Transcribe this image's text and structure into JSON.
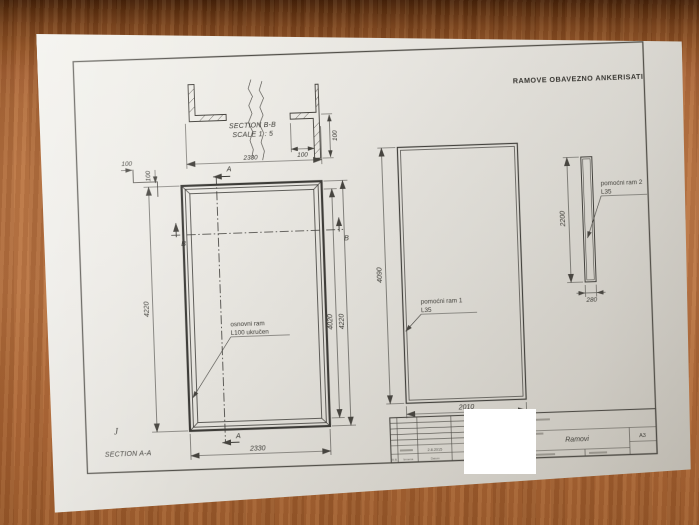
{
  "note": "RAMOVE OBAVEZNO ANKERISATI",
  "sectionBB": {
    "title": "SECTION B-B",
    "scale": "SCALE 1 : 5",
    "dimWidth": "2330",
    "dimLeg": "100",
    "dimFlange": "100"
  },
  "cornerDetail": {
    "dimH": "100",
    "dimV": "100"
  },
  "mainFrame": {
    "label1": "osnovni ram",
    "label2": "L100 ukručen",
    "dimLeft": "4220",
    "dimRightInner": "4020",
    "dimRightOuter": "4220",
    "dimBottom": "2330",
    "markerA": "A",
    "markerB": "B",
    "sectionLabel": "SECTION A-A",
    "cornerMark": "J"
  },
  "frame2": {
    "label1": "pomoćni ram 1",
    "label2": "L35",
    "dimLeft": "4090",
    "dimBottom": "2010"
  },
  "frame3": {
    "label1": "pomoćni ram 2",
    "label2": "L35",
    "dimLeft": "2200",
    "dimBottom": "280"
  },
  "titleBlock": {
    "title": "Ramovi",
    "format": "A3",
    "date": "2.8.2015",
    "revCols": [
      "R.B.",
      "Izmena",
      "Datum",
      "Potpis"
    ]
  }
}
